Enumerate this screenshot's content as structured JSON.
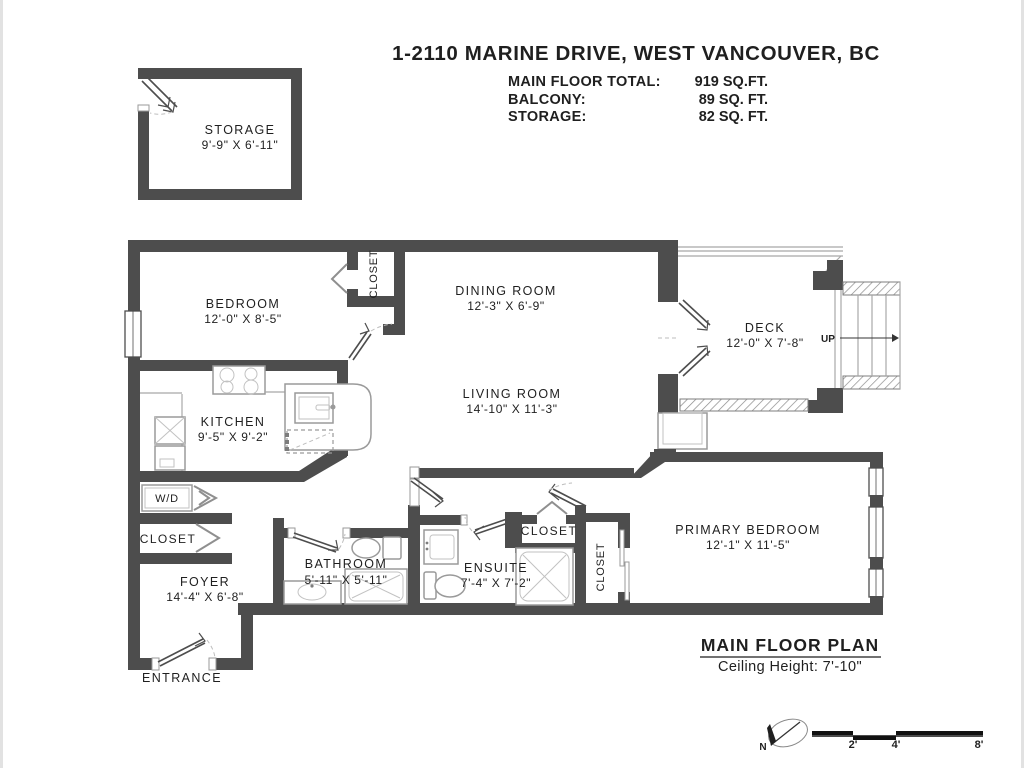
{
  "header": {
    "title": "1-2110 MARINE DRIVE, WEST VANCOUVER, BC",
    "areas": [
      {
        "label": "MAIN FLOOR TOTAL:",
        "value": "919 SQ.FT."
      },
      {
        "label": "BALCONY:",
        "value": "89 SQ. FT."
      },
      {
        "label": "STORAGE:",
        "value": "82 SQ. FT."
      }
    ]
  },
  "rooms": {
    "storage": {
      "name": "STORAGE",
      "dims": "9'-9\" X 6'-11\""
    },
    "bedroom": {
      "name": "BEDROOM",
      "dims": "12'-0\" X 8'-5\""
    },
    "dining": {
      "name": "DINING ROOM",
      "dims": "12'-3\" X 6'-9\""
    },
    "deck": {
      "name": "DECK",
      "dims": "12'-0\" X 7'-8\""
    },
    "living": {
      "name": "LIVING ROOM",
      "dims": "14'-10\" X 11'-3\""
    },
    "kitchen": {
      "name": "KITCHEN",
      "dims": "9'-5\" X 9'-2\""
    },
    "foyer": {
      "name": "FOYER",
      "dims": "14'-4\" X 6'-8\""
    },
    "bathroom": {
      "name": "BATHROOM",
      "dims": "5'-11\" X 5'-11\""
    },
    "ensuite": {
      "name": "ENSUITE",
      "dims": "7'-4\" X 7'-2\""
    },
    "primary": {
      "name": "PRIMARY BEDROOM",
      "dims": "12'-1\" X 11'-5\""
    }
  },
  "labels": {
    "closet": "CLOSET",
    "wd": "W/D",
    "entrance": "ENTRANCE",
    "up": "UP",
    "north": "N"
  },
  "plan": {
    "title": "MAIN FLOOR PLAN",
    "ceiling": "Ceiling Height: 7'-10\""
  },
  "scale": {
    "ticks": [
      "2'",
      "4'",
      "8'"
    ]
  },
  "colors": {
    "wall": "#4d4d4d",
    "fixture": "#9a9a9a",
    "text": "#1f1f1f",
    "background": "#ffffff"
  }
}
